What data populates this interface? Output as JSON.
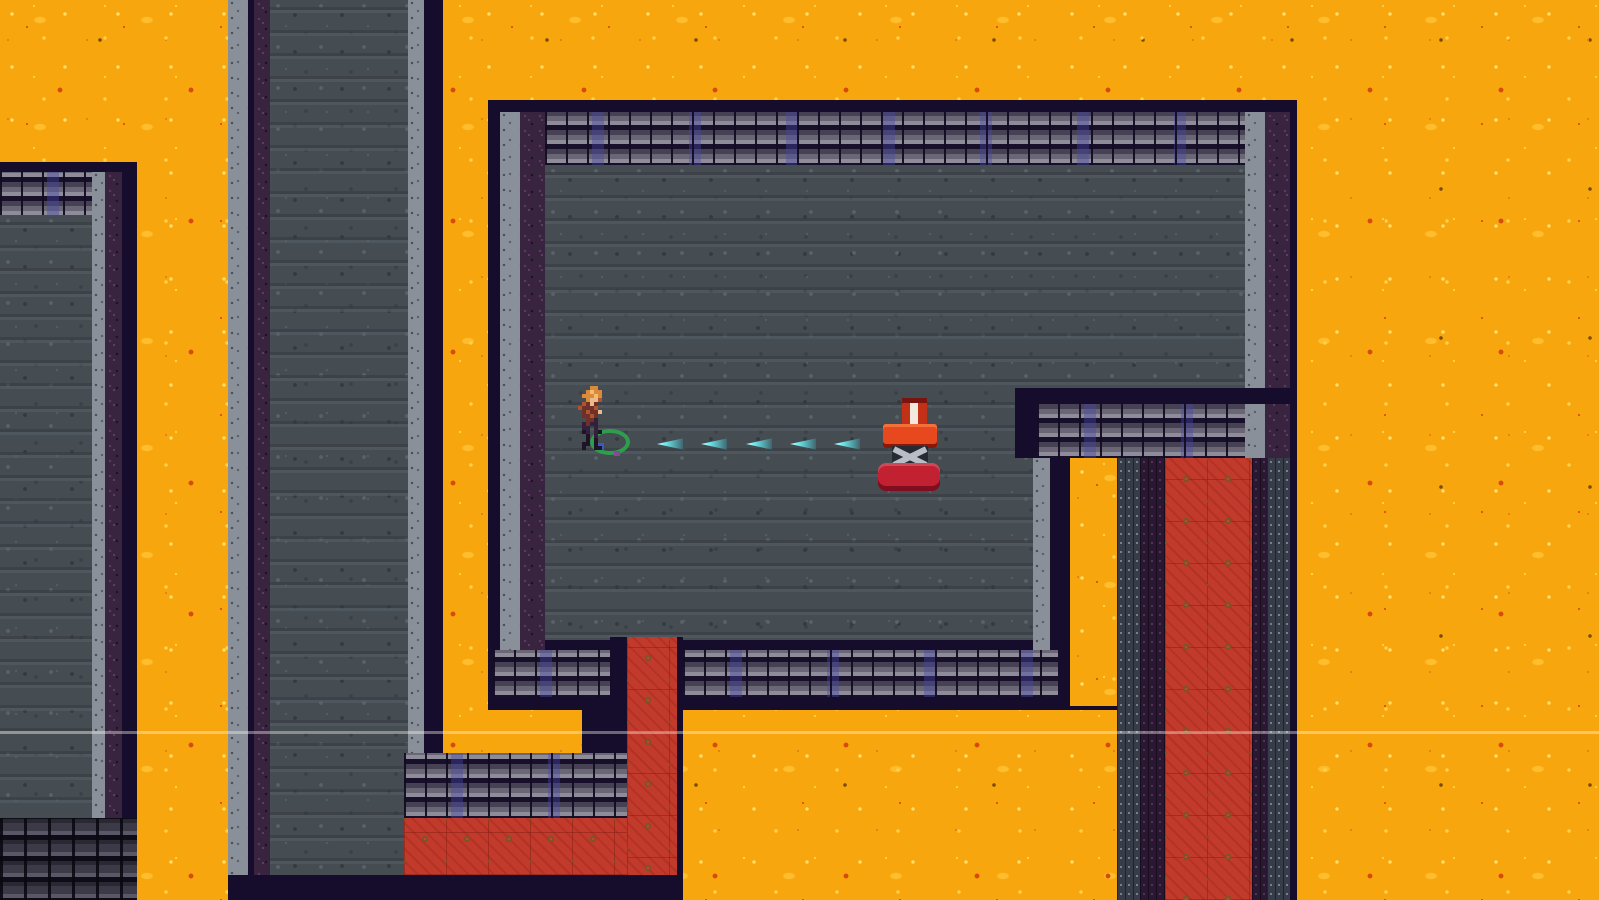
{
  "scene": {
    "type": "game-frame",
    "view": "top-down tile dungeon",
    "theme": "lava caves",
    "visible_text": "none"
  },
  "palette": {
    "lava": "#F7A60D",
    "lava_speck_light": "#FFD24D",
    "lava_speck_hot": "#E0570F",
    "stone_floor": "#454C52",
    "wall_outline_navy": "#150D2B",
    "wall_cap_gray": "#8A9099",
    "wall_cap_purple": "#39243F",
    "brick_light": "#8E8C98",
    "brick_blue_hint": "#4646AA",
    "dark_brick": "#3C3A46",
    "carpet_red": "#C23A2B",
    "carpet_motif_olive": "#7C5428",
    "chain_column": "#363C48",
    "projectile_cyan": "#6FEFF2",
    "machine_orange_red": "#E8481E",
    "machine_crimson": "#C22132",
    "machine_stripe_white": "#F2E8DE",
    "player_hair_orange": "#D98A3A",
    "player_body_maroon": "#70302A",
    "player_ring_green": "#2E9E4C",
    "ring_dot_blue": "#3A58C8"
  },
  "entities": {
    "player": {
      "kind": "adventurer-sprite",
      "x": 578,
      "y": 386,
      "ring": "green-ellipse-at-feet"
    },
    "projectiles": {
      "kind": "cyan-darts",
      "count": 5,
      "direction": "left",
      "y": 437,
      "xs": [
        657,
        701,
        746,
        790,
        834
      ]
    },
    "machine": {
      "kind": "red-press-machine",
      "x": 854,
      "y": 384,
      "parts": [
        "striped-cylinder",
        "top-bar",
        "scissor-legs",
        "bottom-bar"
      ]
    }
  },
  "overlay": {
    "scanline_y": 731
  }
}
